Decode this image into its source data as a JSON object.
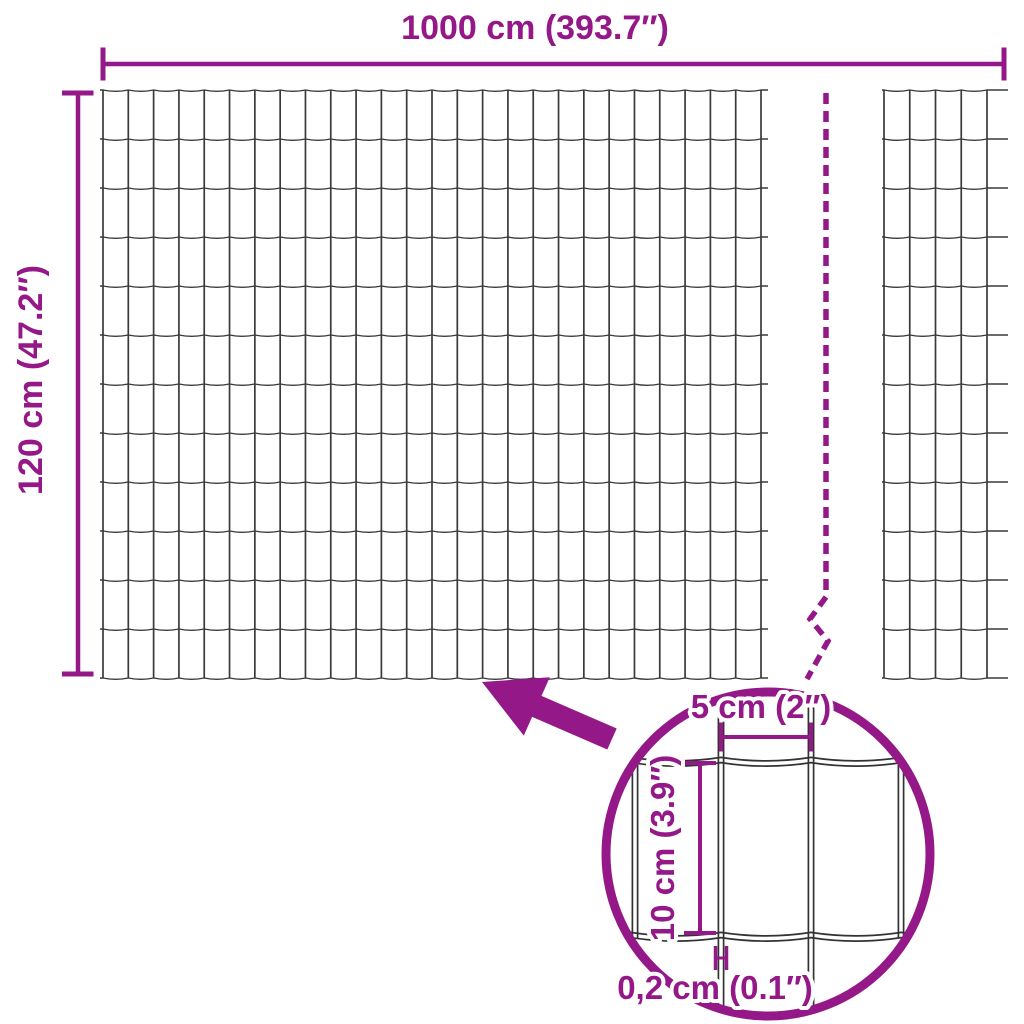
{
  "diagram": {
    "type": "fence-mesh-roll-dimension-diagram",
    "colors": {
      "accent": "#941888",
      "wire": "#3a3a3a",
      "detail_wire": "#333333",
      "background": "#ffffff"
    },
    "labels": {
      "total_width": "1000 cm (393.7″)",
      "total_height": "120 cm (47.2″)",
      "detail_mesh_width": "5 cm (2″)",
      "detail_mesh_height": "10 cm (3.9″)",
      "detail_wire_thickness": "0,2 cm (0.1″)"
    },
    "icons": {
      "zoom_arrow": "arrow-pointing-up-left",
      "magnifier_circle": "detail-zoom-circle",
      "break_line": "dashed-continuation-line"
    }
  }
}
